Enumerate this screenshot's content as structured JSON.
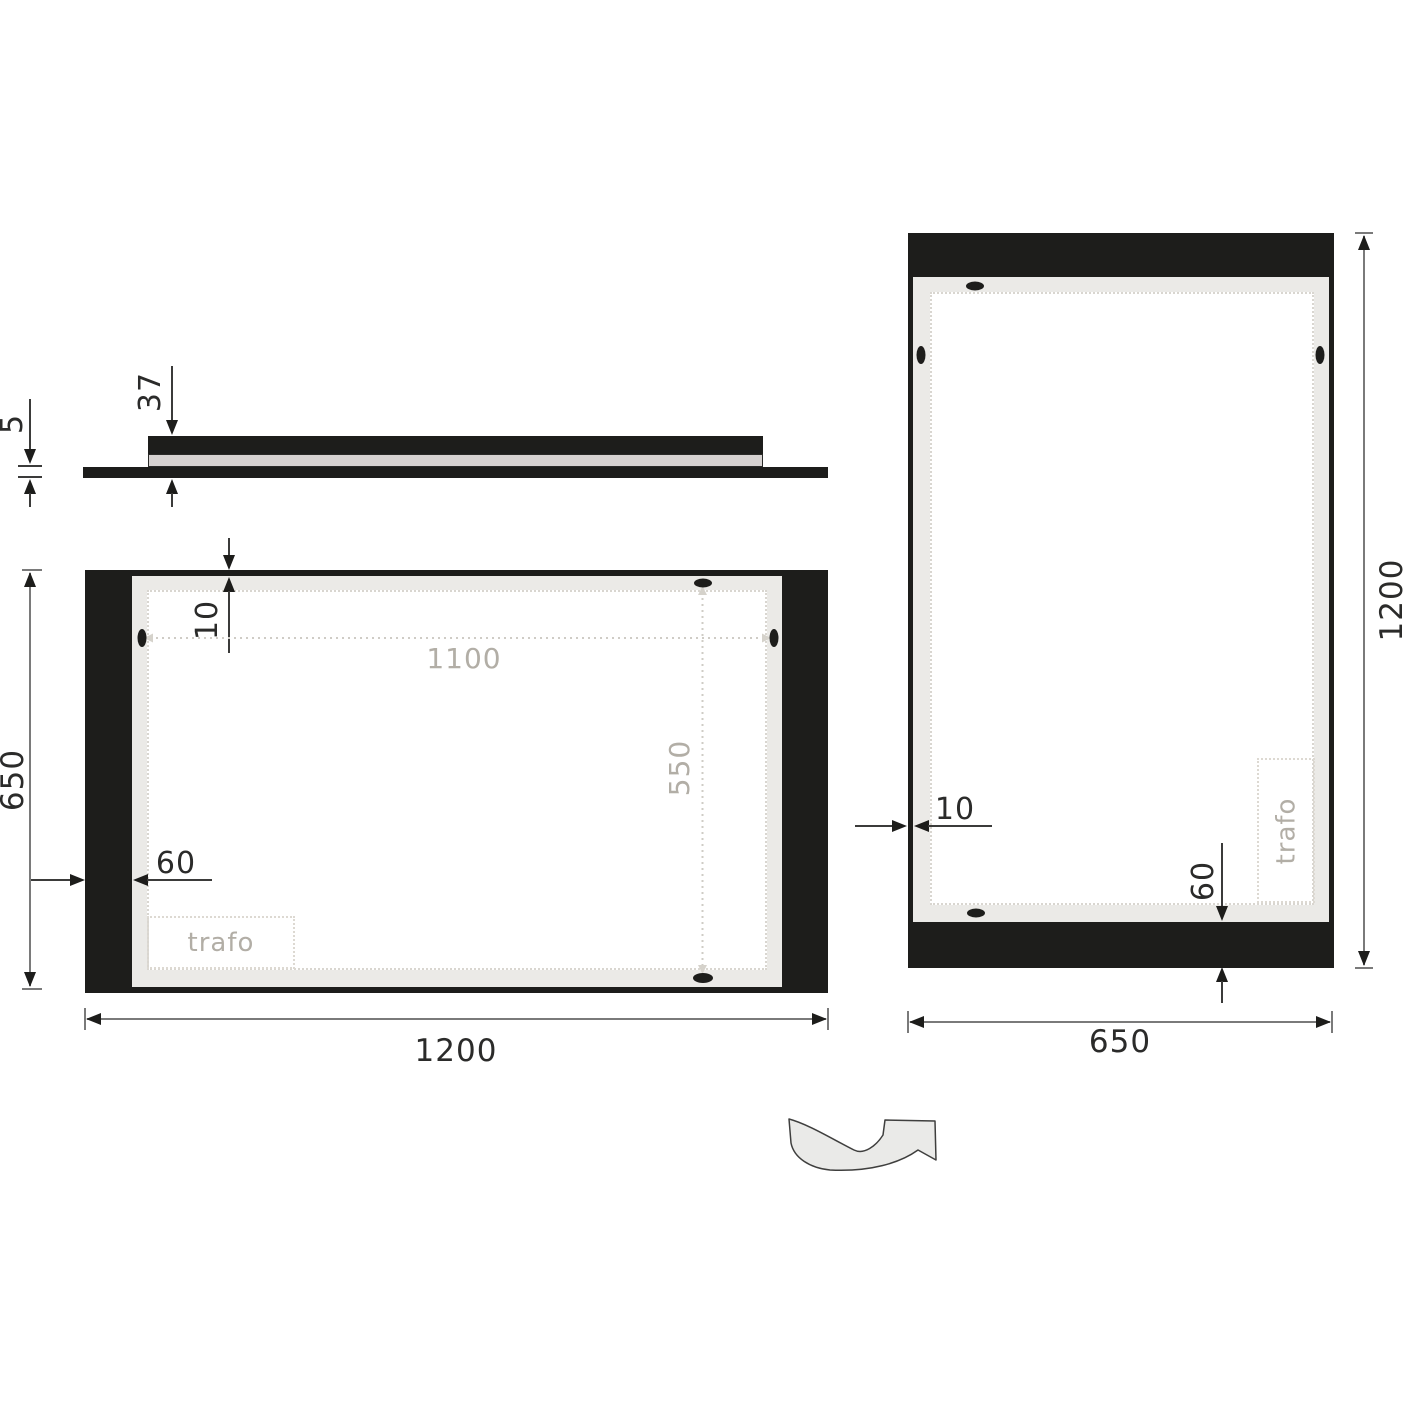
{
  "side_view": {
    "depth_label": "37",
    "glass_label": "5"
  },
  "front_view": {
    "top_inset_label": "10",
    "side_inset_label": "60",
    "led_width_label": "1100",
    "led_height_label": "550",
    "trafo_label": "trafo",
    "height_label": "650",
    "width_label": "1200"
  },
  "portrait_view": {
    "side_inset_label": "10",
    "bottom_inset_label": "60",
    "trafo_label": "trafo",
    "height_label": "1200",
    "width_label": "650"
  },
  "colors": {
    "c-black": "#1d1d1b",
    "c-panel": "#ebeae7",
    "c-glass": "#d6d2d1",
    "c-muted": "#b2aea6",
    "c-text": "#2b2b2a",
    "c-line": "#3b3b3a",
    "c-line2": "#7a7a7a",
    "c-dot": "#d9d6d0",
    "c-arrowfill": "#eaeae8"
  }
}
